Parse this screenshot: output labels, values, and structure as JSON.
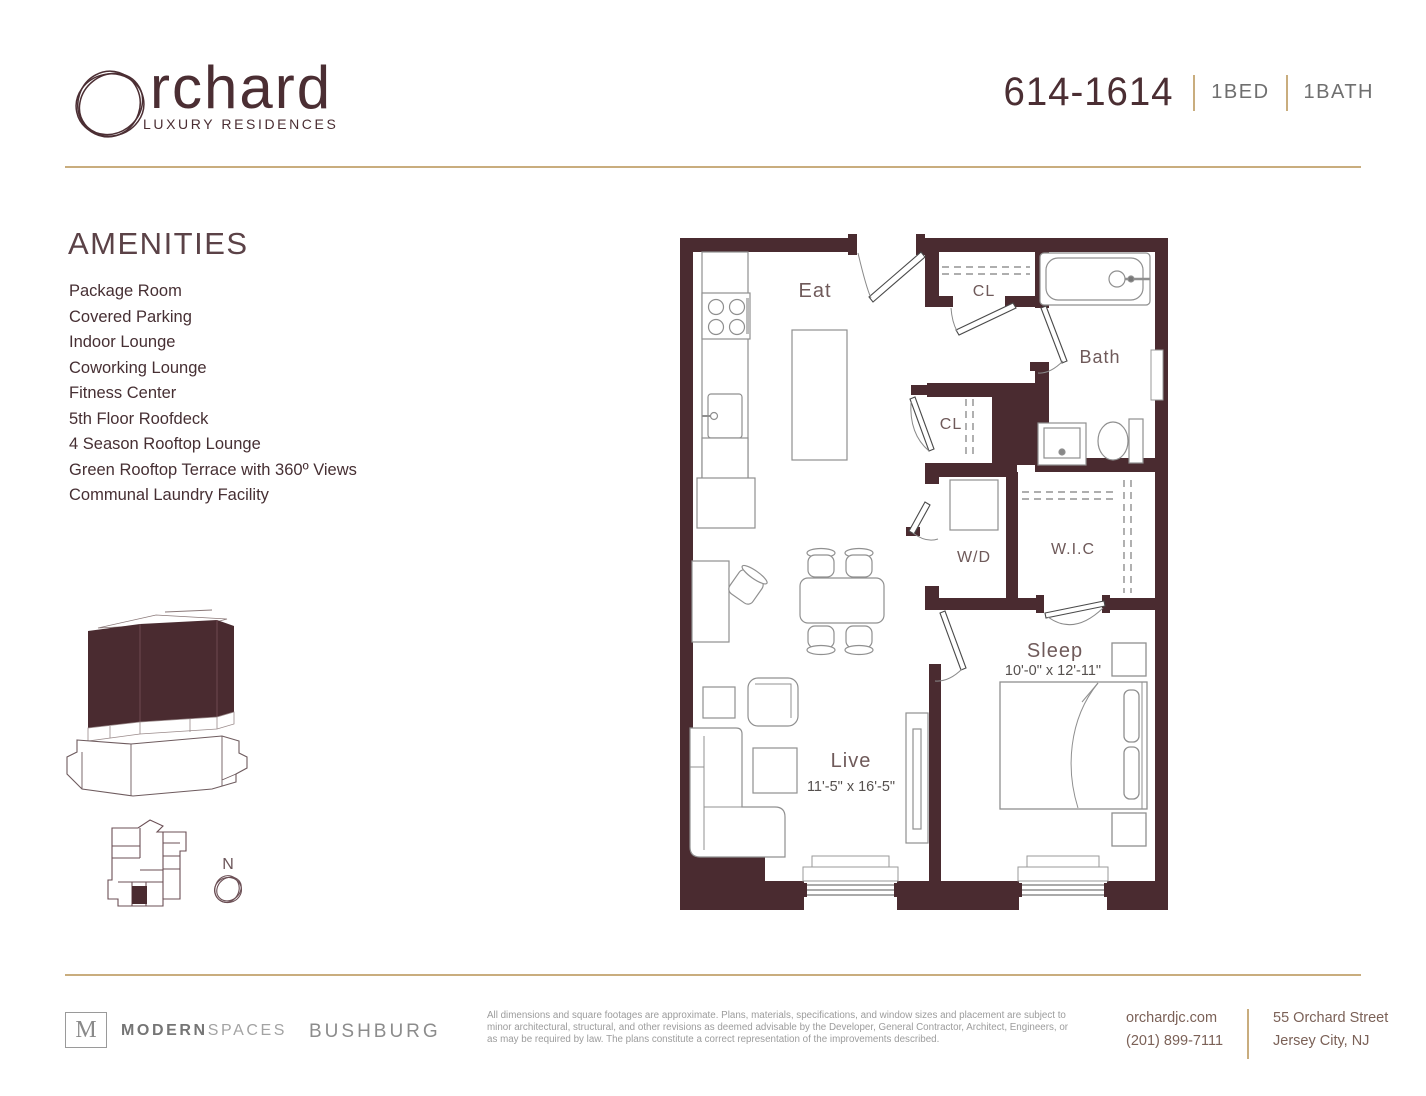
{
  "header": {
    "brand": {
      "wordmark_rest": "rchard",
      "tagline": "LUXURY RESIDENCES"
    },
    "unit": {
      "number": "614-1614",
      "bed": "1BED",
      "bath": "1BATH"
    }
  },
  "amenities": {
    "title": "AMENITIES",
    "items": [
      "Package Room",
      "Covered Parking",
      "Indoor Lounge",
      "Coworking Lounge",
      "Fitness Center",
      "5th Floor Roofdeck",
      "4 Season Rooftop Lounge",
      "Green Rooftop Terrace with 360º Views",
      "Communal Laundry Facility"
    ]
  },
  "floorplan": {
    "labels": {
      "eat": "Eat",
      "closet1": "CL",
      "bath": "Bath",
      "closet2": "CL",
      "washer_dryer": "W/D",
      "walk_in_closet": "W.I.C",
      "sleep": "Sleep",
      "live": "Live"
    },
    "dims": {
      "sleep": "10'-0\" x 12'-11\"",
      "live": "11'-5\" x 16'-5\""
    }
  },
  "keyplan": {
    "north": "N"
  },
  "footer": {
    "brokerage_logo_letter": "M",
    "brokerage_bold": "MODERN",
    "brokerage_light": "SPACES",
    "developer": "BUSHBURG",
    "disclaimer": "All dimensions and square footages are approximate. Plans, materials, specifications, and window sizes and placement are subject to minor architectural, structural, and other revisions as deemed advisable by the Developer, General Contractor, Architect, Engineers, or as may be required by law. The plans constitute a correct representation of the improvements described.",
    "website": "orchardjc.com",
    "phone": "(201) 899-7111",
    "address1": "55 Orchard Street",
    "address2": "Jersey City, NJ"
  },
  "colors": {
    "wall": "#4a2b30",
    "accent": "#c9ad7e",
    "brand": "#4b2e33"
  }
}
